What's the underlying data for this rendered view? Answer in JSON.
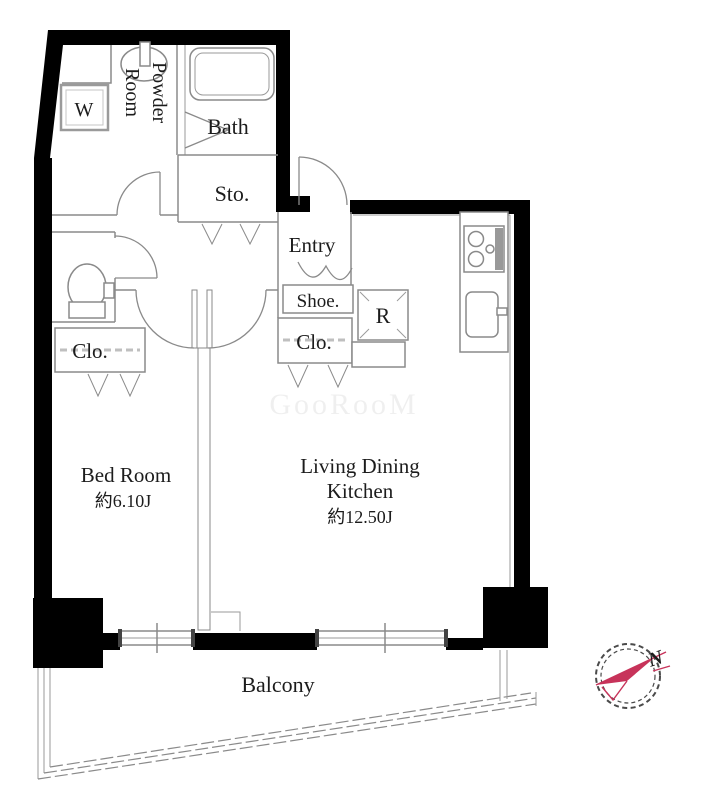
{
  "plan": {
    "rooms": {
      "washer": "W",
      "powder_line1": "Powder",
      "powder_line2": "Room",
      "bath": "Bath",
      "storage": "Sto.",
      "entry": "Entry",
      "shoe": "Shoe.",
      "closet_ldk": "Clo.",
      "closet_bedroom": "Clo.",
      "refrigerator": "R",
      "bedroom_name": "Bed Room",
      "bedroom_size": "約6.10J",
      "ldk_line1": "Living Dining",
      "ldk_line2": "Kitchen",
      "ldk_size": "約12.50J",
      "balcony": "Balcony"
    },
    "compass": {
      "north_label": "N",
      "needle_color": "#c7335a"
    },
    "watermark": "GooRooM",
    "colors": {
      "wall": "#000000",
      "line": "#8a8a8a",
      "text": "#1c1c1c",
      "background": "#ffffff"
    }
  }
}
